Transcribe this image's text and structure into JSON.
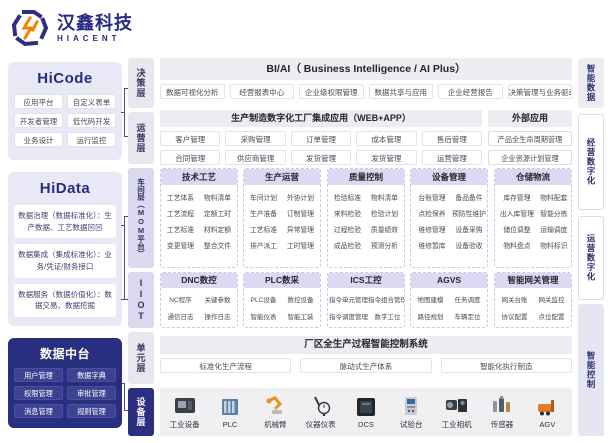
{
  "logo": {
    "brand_cn": "汉鑫科技",
    "brand_en": "HIACENT"
  },
  "left": {
    "hicode": {
      "title": "HiCode",
      "items": [
        "应用平台",
        "自定义表单",
        "开发者管理",
        "低代码开发",
        "业务设计",
        "运行监控"
      ]
    },
    "hidata": {
      "title": "HiData",
      "items": [
        "数据治理（数据标准化）：生产数据、工艺数据⊠⊠",
        "数据集成（集成标准化）：业务/凭证/财务接口",
        "数据服务（数据价值化）：数据交易、数据挖掘"
      ]
    },
    "data_center": {
      "title": "数据中台",
      "items": [
        "用户管理",
        "数据字典",
        "权限管理",
        "审批管理",
        "消息管理",
        "规则管理"
      ]
    }
  },
  "layers": [
    "决策层",
    "运营层",
    "车间层（MOM平台）",
    "IIOT",
    "单元层",
    "设备层"
  ],
  "decision": {
    "header": "BI/AI（ Business Intelligence  / AI Plus）",
    "items": [
      "数据可视化分析",
      "经营报表中心",
      "企业级权限管理",
      "数据共享与应用",
      "企业经营报告",
      "决策管理与业务驱动"
    ]
  },
  "operations": {
    "header_main": "生产制造数字化工厂集成应用（WEB+APP）",
    "header_external": "外部应用",
    "rows": [
      [
        "客户管理",
        "采购管理",
        "订单管理",
        "成本管理",
        "售后管理"
      ],
      [
        "合同管理",
        "供应商管理",
        "发货管理",
        "发货管理",
        "运营管理"
      ]
    ],
    "external": [
      "产品全生命周期管理",
      "企业资源计划管理"
    ]
  },
  "mom": {
    "columns": [
      {
        "title": "技术工艺",
        "items": [
          "工艺体系",
          "物料清单",
          "工艺流程",
          "定额工时",
          "工艺标准",
          "材料定额",
          "变更管理",
          "整合文件"
        ]
      },
      {
        "title": "生产运营",
        "items": [
          "车间计划",
          "外协计划",
          "生产准备",
          "订制管理",
          "工艺标准",
          "异常管理",
          "排产派工",
          "工时管理"
        ]
      },
      {
        "title": "质量控制",
        "items": [
          "检验标准",
          "物料清单",
          "来料检验",
          "检验计划",
          "过程检验",
          "质量绩效",
          "成品检验",
          "预测分析"
        ]
      },
      {
        "title": "设备管理",
        "items": [
          "台账管理",
          "备品备件",
          "点检保养",
          "预防性维护",
          "维修管理",
          "设备采购",
          "维修暂库",
          "设备验收"
        ]
      },
      {
        "title": "仓储物流",
        "items": [
          "库存管理",
          "物料配套",
          "出入库管理",
          "智能分拣",
          "储位调整",
          "运输调度",
          "物料盘点",
          "物料标识"
        ]
      }
    ]
  },
  "iiot": {
    "columns": [
      {
        "title": "DNC数控",
        "items": [
          "NC程序",
          "关键参数",
          "通信日志",
          "操作日志"
        ]
      },
      {
        "title": "PLC数采",
        "items": [
          "PLC设备",
          "数控设备",
          "智能仪表",
          "智能工装"
        ]
      },
      {
        "title": "ICS工控",
        "items": [
          "指令单元管理",
          "指令组合管理",
          "指令调度管理",
          "数字工位"
        ]
      },
      {
        "title": "AGVS",
        "items": [
          "地图建模",
          "任务调度",
          "路径规划",
          "车辆定位"
        ]
      },
      {
        "title": "智能网关管理",
        "items": [
          "网关台账",
          "网关监控",
          "协议配置",
          "点位配置"
        ]
      }
    ]
  },
  "unit": {
    "header": "厂区全生产过程智能控制系统",
    "items": [
      "标准化生产流程",
      "脉动式生产体系",
      "智能化执行制造"
    ]
  },
  "devices": [
    "工业设备",
    "PLC",
    "机械臂",
    "仪器仪表",
    "DCS",
    "试验台",
    "工业相机",
    "传感器",
    "AGV"
  ],
  "right": [
    "智能数据",
    "经营数字化",
    "运营数字化",
    "智能控制"
  ],
  "colors": {
    "navy": "#2b2e83",
    "orange": "#f08300",
    "panel_purple": "#e9e8f6",
    "header_grey": "#ececf1",
    "mom_header": "#dcd9f2",
    "dark_panel": "#292f7f"
  }
}
